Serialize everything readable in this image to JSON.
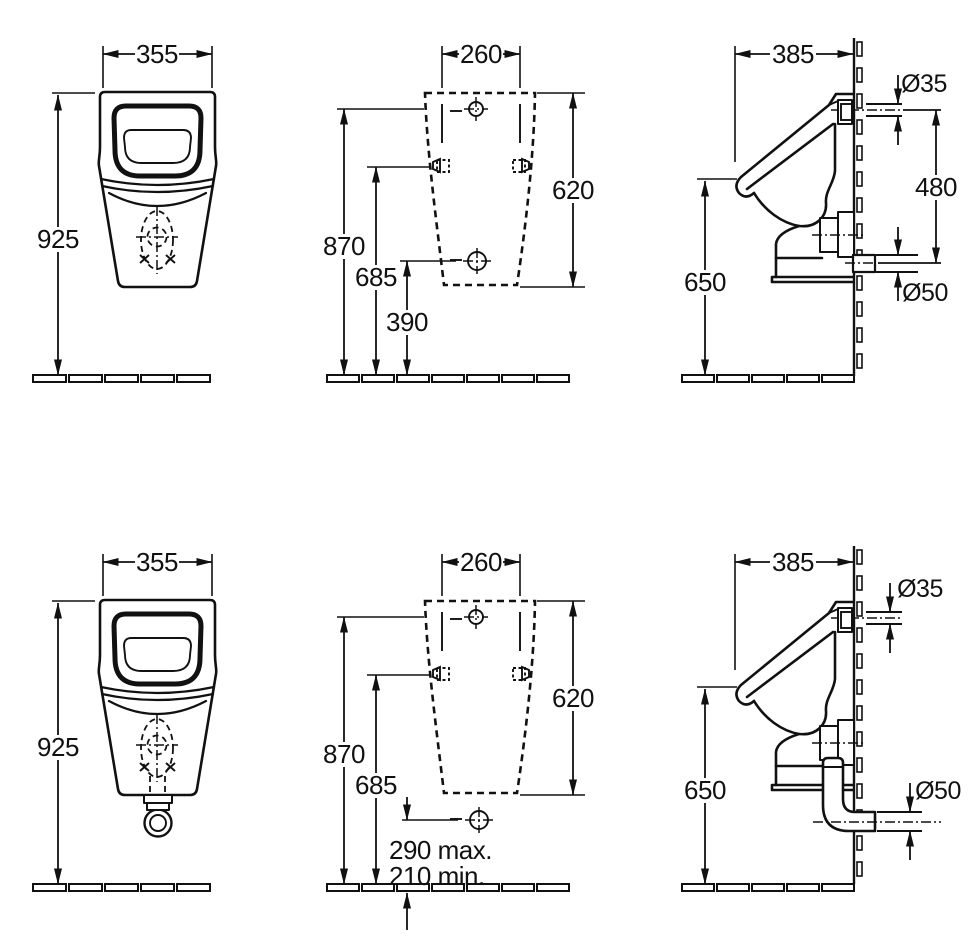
{
  "page": {
    "background": "#ffffff",
    "ink": "#111111"
  },
  "views": {
    "top_front": {
      "label": "front view",
      "width": "355",
      "height": "925"
    },
    "top_back": {
      "label": "rear mounting view",
      "width": "260",
      "outline_height": "620",
      "inlet_height": "870",
      "fixing_height": "685",
      "outlet_height": "390"
    },
    "top_side": {
      "label": "side view concealed outlet",
      "depth": "385",
      "inlet_diameter": "Ø35",
      "connection_spacing": "480",
      "outlet_diameter": "Ø50",
      "rim_height": "650"
    },
    "bottom_front": {
      "label": "front view with siphon",
      "width": "355",
      "height": "925"
    },
    "bottom_back": {
      "label": "rear mounting view floor outlet",
      "width": "260",
      "outline_height": "620",
      "inlet_height": "870",
      "fixing_height": "685",
      "outlet_height_max": "290 max.",
      "outlet_height_min": "210 min."
    },
    "bottom_side": {
      "label": "side view with siphon",
      "depth": "385",
      "inlet_diameter": "Ø35",
      "outlet_diameter": "Ø50",
      "rim_height": "650"
    }
  }
}
